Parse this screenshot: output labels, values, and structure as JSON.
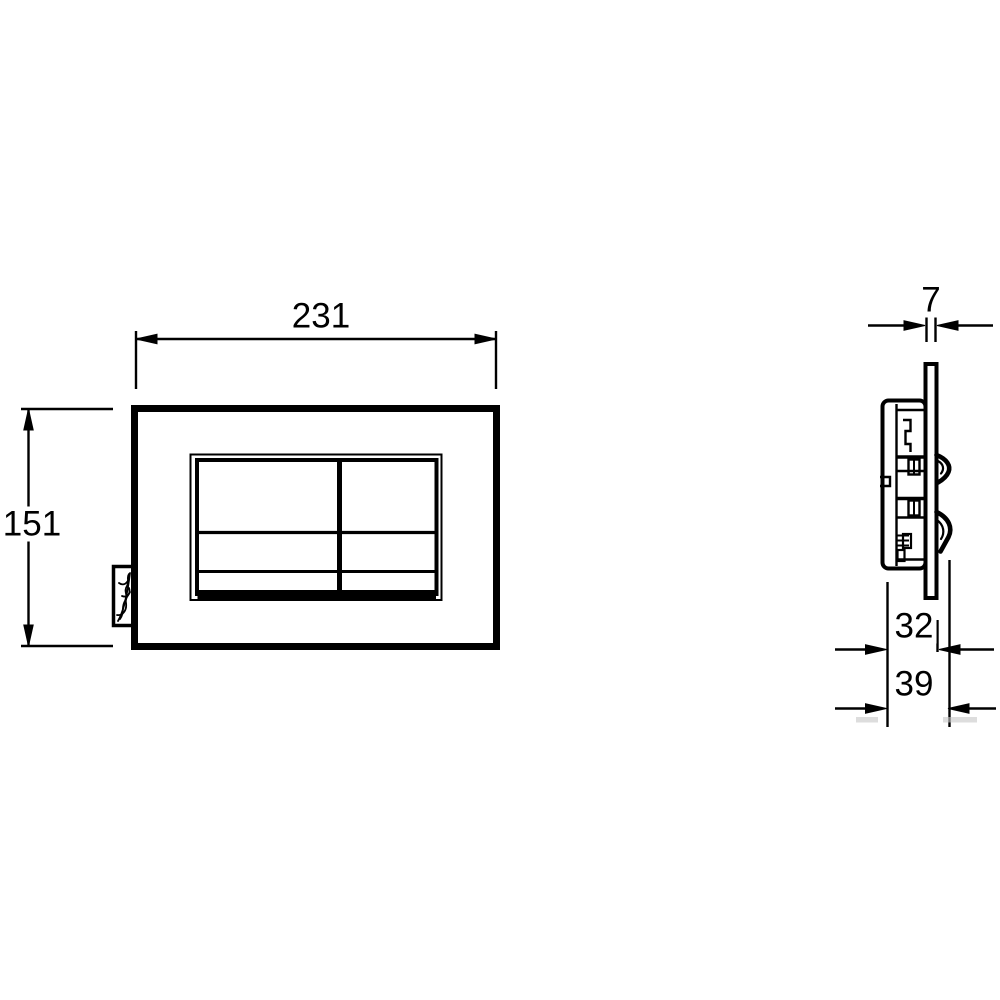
{
  "drawing": {
    "kind": "technical-drawing-flush-plate",
    "background_color": "#ffffff",
    "line_color": "#000000",
    "smudge_color": "#c6c6c6",
    "dimensions": {
      "width": "231",
      "height": "151",
      "thickness": "7",
      "depth_inner": "32",
      "depth_total": "39"
    },
    "icons": {
      "brand_logo": "brand-logo-scribble"
    }
  }
}
